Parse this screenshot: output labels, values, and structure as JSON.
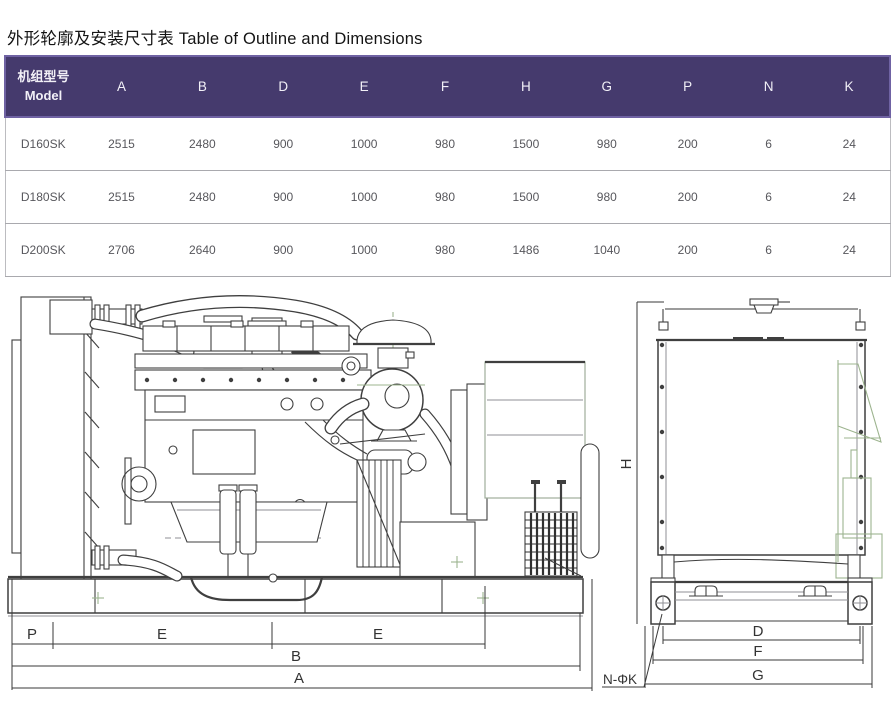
{
  "page": {
    "title": "外形轮廓及安装尺寸表 Table of Outline and Dimensions"
  },
  "colors": {
    "header_bg": "#453a6d",
    "header_border": "#6f62a3",
    "row_separator": "#a9a9ae",
    "drawing_line": "#3f3f3f",
    "drawing_accent_green": "#9db48f"
  },
  "table": {
    "model_header": {
      "zh": "机组型号",
      "en": "Model"
    },
    "columns": [
      "A",
      "B",
      "D",
      "E",
      "F",
      "H",
      "G",
      "P",
      "N",
      "K"
    ],
    "rows": [
      {
        "model": "D160SK",
        "values": [
          "2515",
          "2480",
          "900",
          "1000",
          "980",
          "1500",
          "980",
          "200",
          "6",
          "24"
        ]
      },
      {
        "model": "D180SK",
        "values": [
          "2515",
          "2480",
          "900",
          "1000",
          "980",
          "1500",
          "980",
          "200",
          "6",
          "24"
        ]
      },
      {
        "model": "D200SK",
        "values": [
          "2706",
          "2640",
          "900",
          "1000",
          "980",
          "1486",
          "1040",
          "200",
          "6",
          "24"
        ]
      }
    ]
  },
  "drawings": {
    "side_view": {
      "labels": {
        "p": "P",
        "e1": "E",
        "e2": "E",
        "b": "B",
        "a": "A"
      }
    },
    "end_view": {
      "labels": {
        "h": "H",
        "d": "D",
        "f": "F",
        "g": "G",
        "bolt_callout": "N-ΦK"
      }
    }
  }
}
